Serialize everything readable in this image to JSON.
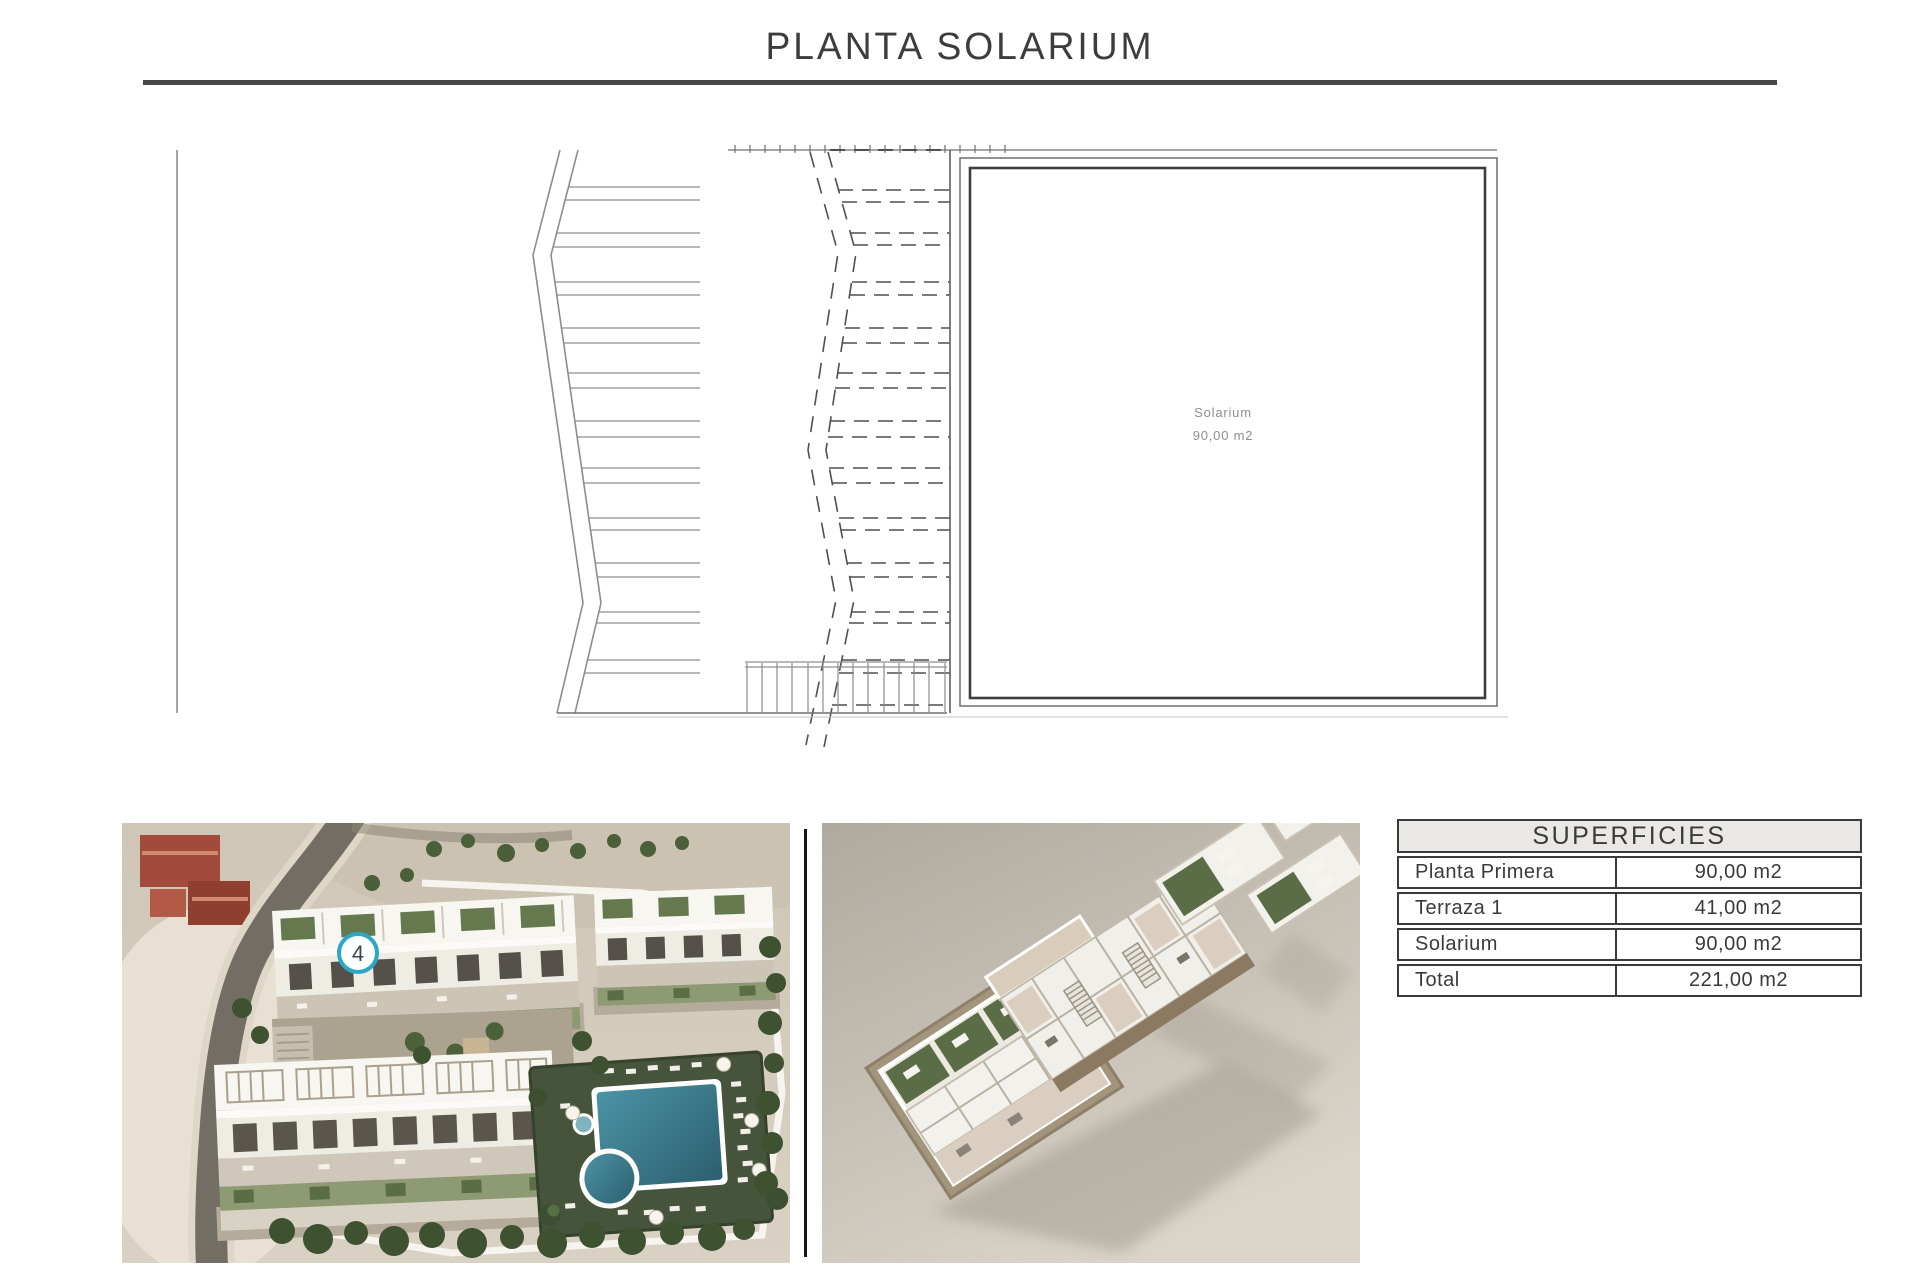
{
  "page": {
    "title": "PLANTA SOLARIUM"
  },
  "plan": {
    "room_label": "Solarium",
    "room_area": "90,00 m2"
  },
  "aerial_render": {
    "unit_marker": "4"
  },
  "surfaces_table": {
    "header": "SUPERFICIES",
    "rows": [
      {
        "label": "Planta Primera",
        "value": "90,00 m2"
      },
      {
        "label": "Terraza 1",
        "value": "41,00 m2"
      },
      {
        "label": "Solarium",
        "value": "90,00 m2"
      },
      {
        "label": "Total",
        "value": "221,00 m2"
      }
    ]
  },
  "colors": {
    "ink": "#3a3a3a",
    "rule": "#474747",
    "marker_ring": "#2ba9c4",
    "plan_label_gray": "#8f8f8f",
    "pool_water": "#35707f"
  }
}
